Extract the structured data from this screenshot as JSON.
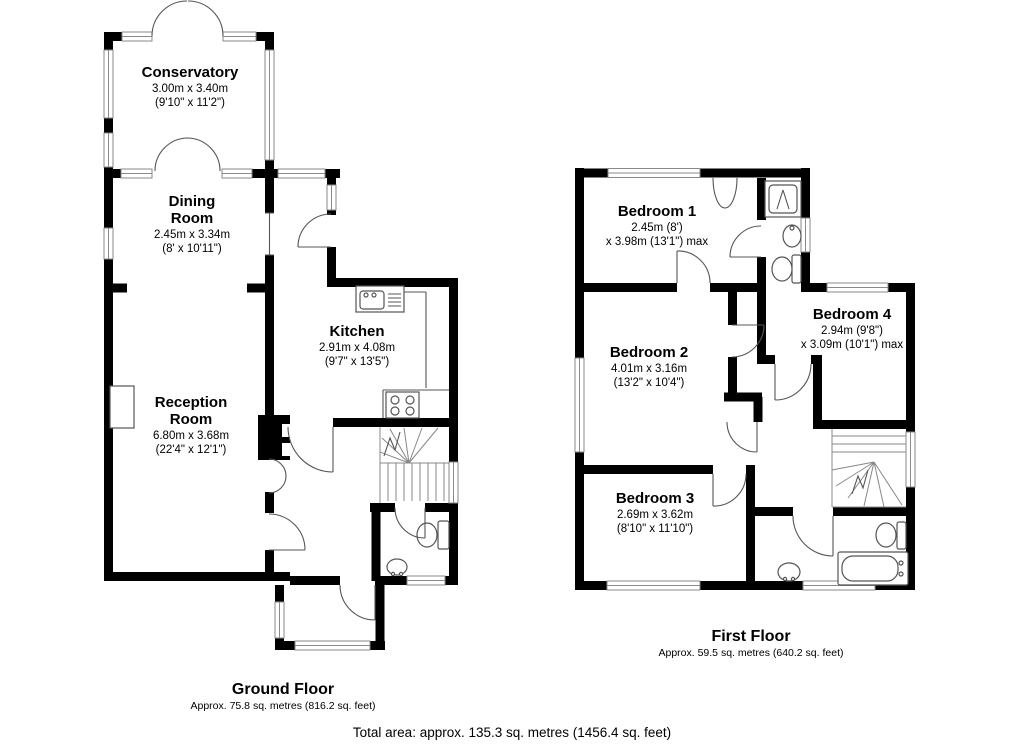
{
  "ground": {
    "title": "Ground Floor",
    "area": "Approx. 75.8 sq. metres (816.2 sq. feet)",
    "rooms": {
      "conservatory": {
        "name": "Conservatory",
        "dim_m": "3.00m x 3.40m",
        "dim_i": "(9'10\" x 11'2\")"
      },
      "dining": {
        "name": "Dining",
        "name2": "Room",
        "dim_m": "2.45m x 3.34m",
        "dim_i": "(8' x 10'11\")"
      },
      "kitchen": {
        "name": "Kitchen",
        "dim_m": "2.91m x 4.08m",
        "dim_i": "(9'7\" x 13'5\")"
      },
      "reception": {
        "name": "Reception",
        "name2": "Room",
        "dim_m": "6.80m x 3.68m",
        "dim_i": "(22'4\" x 12'1\")"
      }
    }
  },
  "first": {
    "title": "First Floor",
    "area": "Approx. 59.5 sq. metres (640.2 sq. feet)",
    "rooms": {
      "bedroom1": {
        "name": "Bedroom 1",
        "dim_m": "2.45m (8')",
        "dim_i": "x 3.98m (13'1\") max"
      },
      "bedroom2": {
        "name": "Bedroom 2",
        "dim_m": "4.01m x 3.16m",
        "dim_i": "(13'2\" x 10'4\")"
      },
      "bedroom3": {
        "name": "Bedroom 3",
        "dim_m": "2.69m x 3.62m",
        "dim_i": "(8'10\" x 11'10\")"
      },
      "bedroom4": {
        "name": "Bedroom 4",
        "dim_m": "2.94m (9'8\")",
        "dim_i": "x 3.09m (10'1\") max"
      }
    }
  },
  "total": {
    "label": "Total area: approx. 135.3 sq. metres (1456.4 sq. feet)"
  },
  "colors": {
    "wall": "#000000",
    "fixture_line": "#555555",
    "window_line": "#8a8a8a",
    "text": "#000000"
  }
}
